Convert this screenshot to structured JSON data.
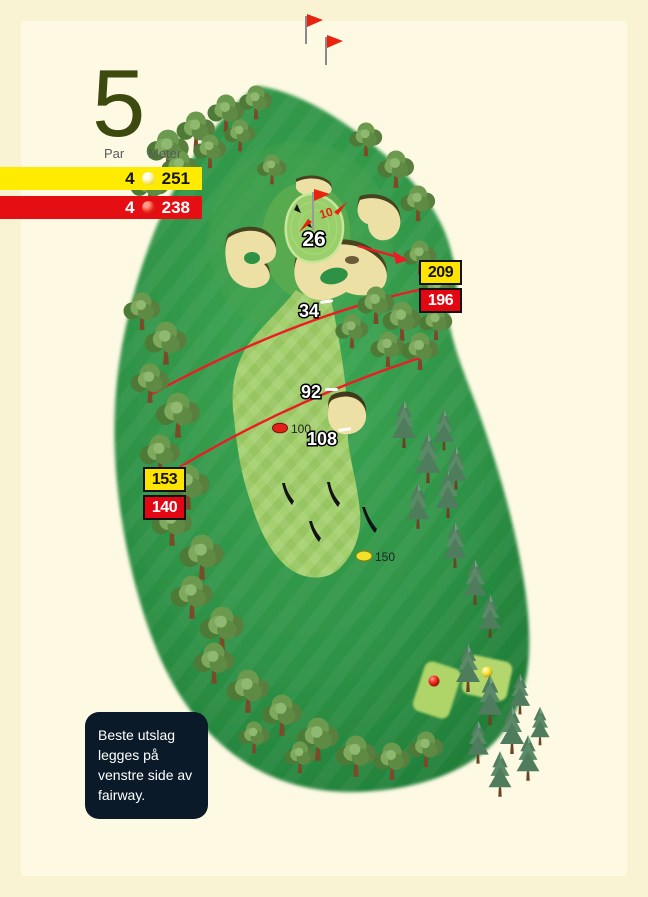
{
  "header": {
    "hole_number": "5",
    "par_label": "Par",
    "meter_label": "Meter",
    "yellow_tee": {
      "par": "4",
      "meters": "251"
    },
    "red_tee": {
      "par": "4",
      "meters": "238"
    }
  },
  "badges": {
    "right": {
      "yellow": "209",
      "red": "196"
    },
    "left": {
      "yellow": "153",
      "red": "140"
    }
  },
  "markers": {
    "green_front": "26",
    "upper": "34",
    "mid": "92",
    "lower": "108",
    "pin_depth": "10"
  },
  "balls": {
    "red_label": "100",
    "yellow_label": "150"
  },
  "note": {
    "text": "Beste utslag legges på venstre side av fairway."
  },
  "colors": {
    "background": "#F9F2D3",
    "tee_yellow": "#FFEB00",
    "tee_red": "#E50E13",
    "line_red": "#ED1B24",
    "rough_green": "#2E9246",
    "fairway_green": "#A5D06F",
    "sand": "#EDE0A4",
    "note_navy": "#0B1A29",
    "hole_number_olive": "#3C4A10"
  }
}
